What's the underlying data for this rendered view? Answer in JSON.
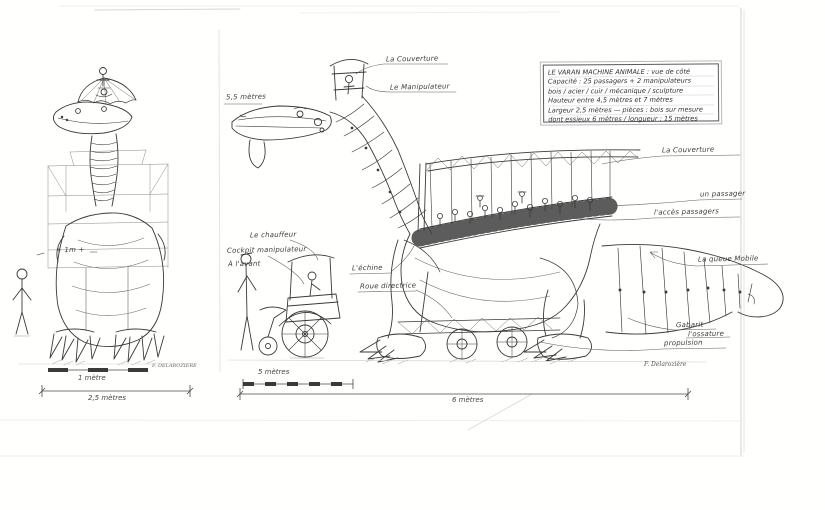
{
  "drawing": {
    "subject": "Le Varan - machine animale (croquis technique)",
    "title_block": {
      "lines": [
        "LE VARAN  MACHINE ANIMALE : vue de côté",
        "Capacité : 25 passagers + 2 manipulateurs",
        "bois / acier / cuir / mécanique / sculpture",
        "Hauteur entre 4,5 mètres et 7 mètres",
        "Largeur 2,5 mètres — pièces : bois sur mesure",
        "dont essieux 6 mètres / longueur : 15 mètres"
      ]
    },
    "annotations": {
      "couverture_top": "La Couverture",
      "manipulateur": "Le Manipulateur",
      "couverture_right": "La Couverture",
      "passager": "un passager",
      "acces": "l'accès passagers",
      "queue_mobile": "La queue Mobile",
      "gabarit": "Gabarit",
      "ossature": "l'ossature",
      "propulsion": "propulsion",
      "echine": "L'échine",
      "roue_directrice": "Roue directrice",
      "chauffeur": "Le chauffeur",
      "cockpit": "Cockpit manipulateur",
      "a_lavant": "À l'avant",
      "hauteur_tete": "5,5 mètres",
      "echelle_humaine": "+ 1m +"
    },
    "dimensions": {
      "front_scale_label": "1 mètre",
      "front_width": "2,5 mètres",
      "side_scale_label": "5 mètres",
      "side_length": "6 mètres"
    },
    "signatures": {
      "front": "F. DELAROZIERE",
      "side": "F. Delarozière"
    },
    "colors": {
      "ink": "#3a3a3a",
      "light_ink": "#777777",
      "paper_edge": "#d8d8d8"
    }
  }
}
